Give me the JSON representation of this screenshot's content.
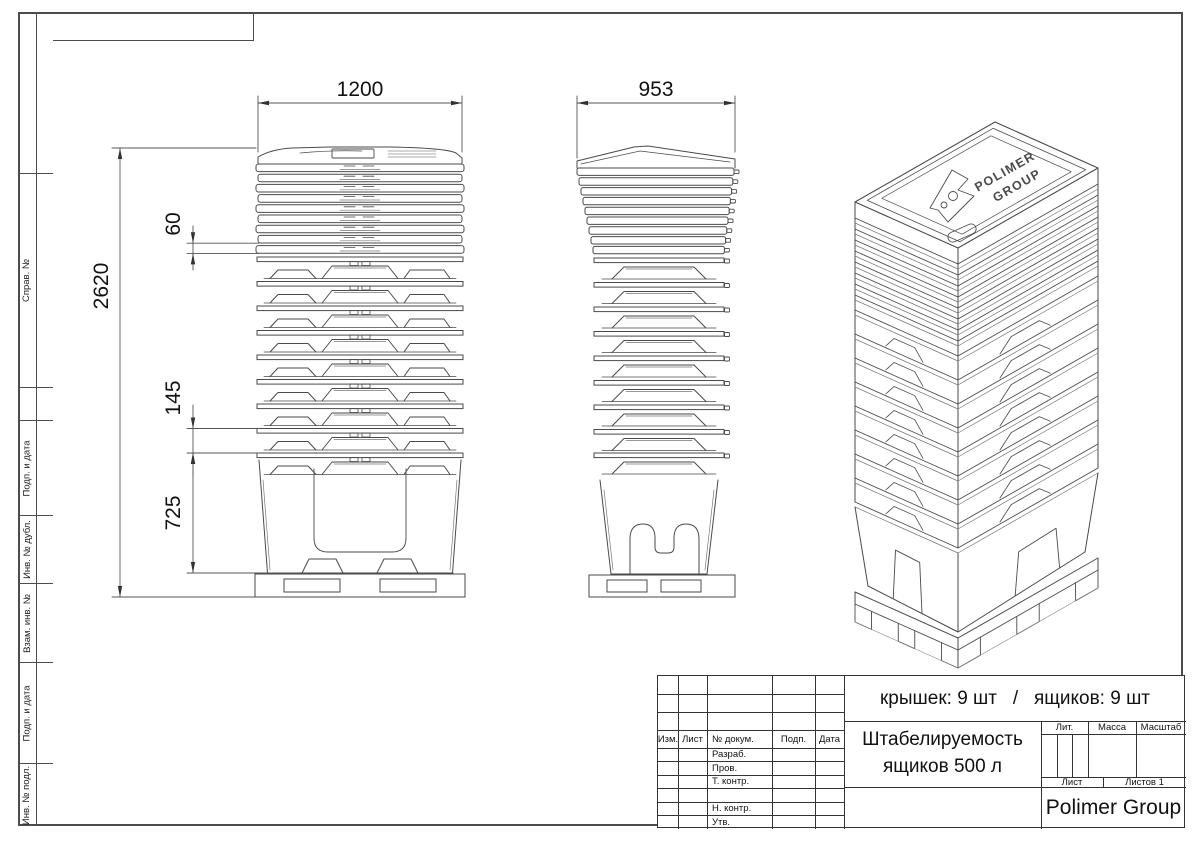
{
  "frame": {
    "strip_cells": [
      {
        "label": ""
      },
      {
        "label": "Справ. №"
      },
      {
        "label": "Подп. и дата"
      },
      {
        "label": "Инв. № дубл."
      },
      {
        "label": "Взам. инв. №"
      },
      {
        "label": "Подп. и дата"
      },
      {
        "label": "Инв. № подл."
      }
    ]
  },
  "dimensions": {
    "front_width": "1200",
    "side_width": "953",
    "lid_pitch": "60",
    "total_height": "2620",
    "box_pitch": "145",
    "bottom_box_height": "725"
  },
  "iso_brand": {
    "line1": "POLIMER",
    "line2": "GROUP"
  },
  "title_block": {
    "summary": "крышек: 9 шт   /   ящиков: 9 шт",
    "title_line1": "Штабелируемость",
    "title_line2": "ящиков 500 л",
    "company": "Polimer Group",
    "header_cols": [
      "Изм.",
      "Лист",
      "№ докум.",
      "Подп.",
      "Дата"
    ],
    "sig_rows": [
      "Разраб.",
      "Пров.",
      "Т. контр.",
      "",
      "Н. контр.",
      "Утв."
    ],
    "lit_label": "Лит.",
    "mass_label": "Масса",
    "scale_label": "Масштаб",
    "sheet_label": "Лист",
    "sheets_label": "Листов 1"
  }
}
